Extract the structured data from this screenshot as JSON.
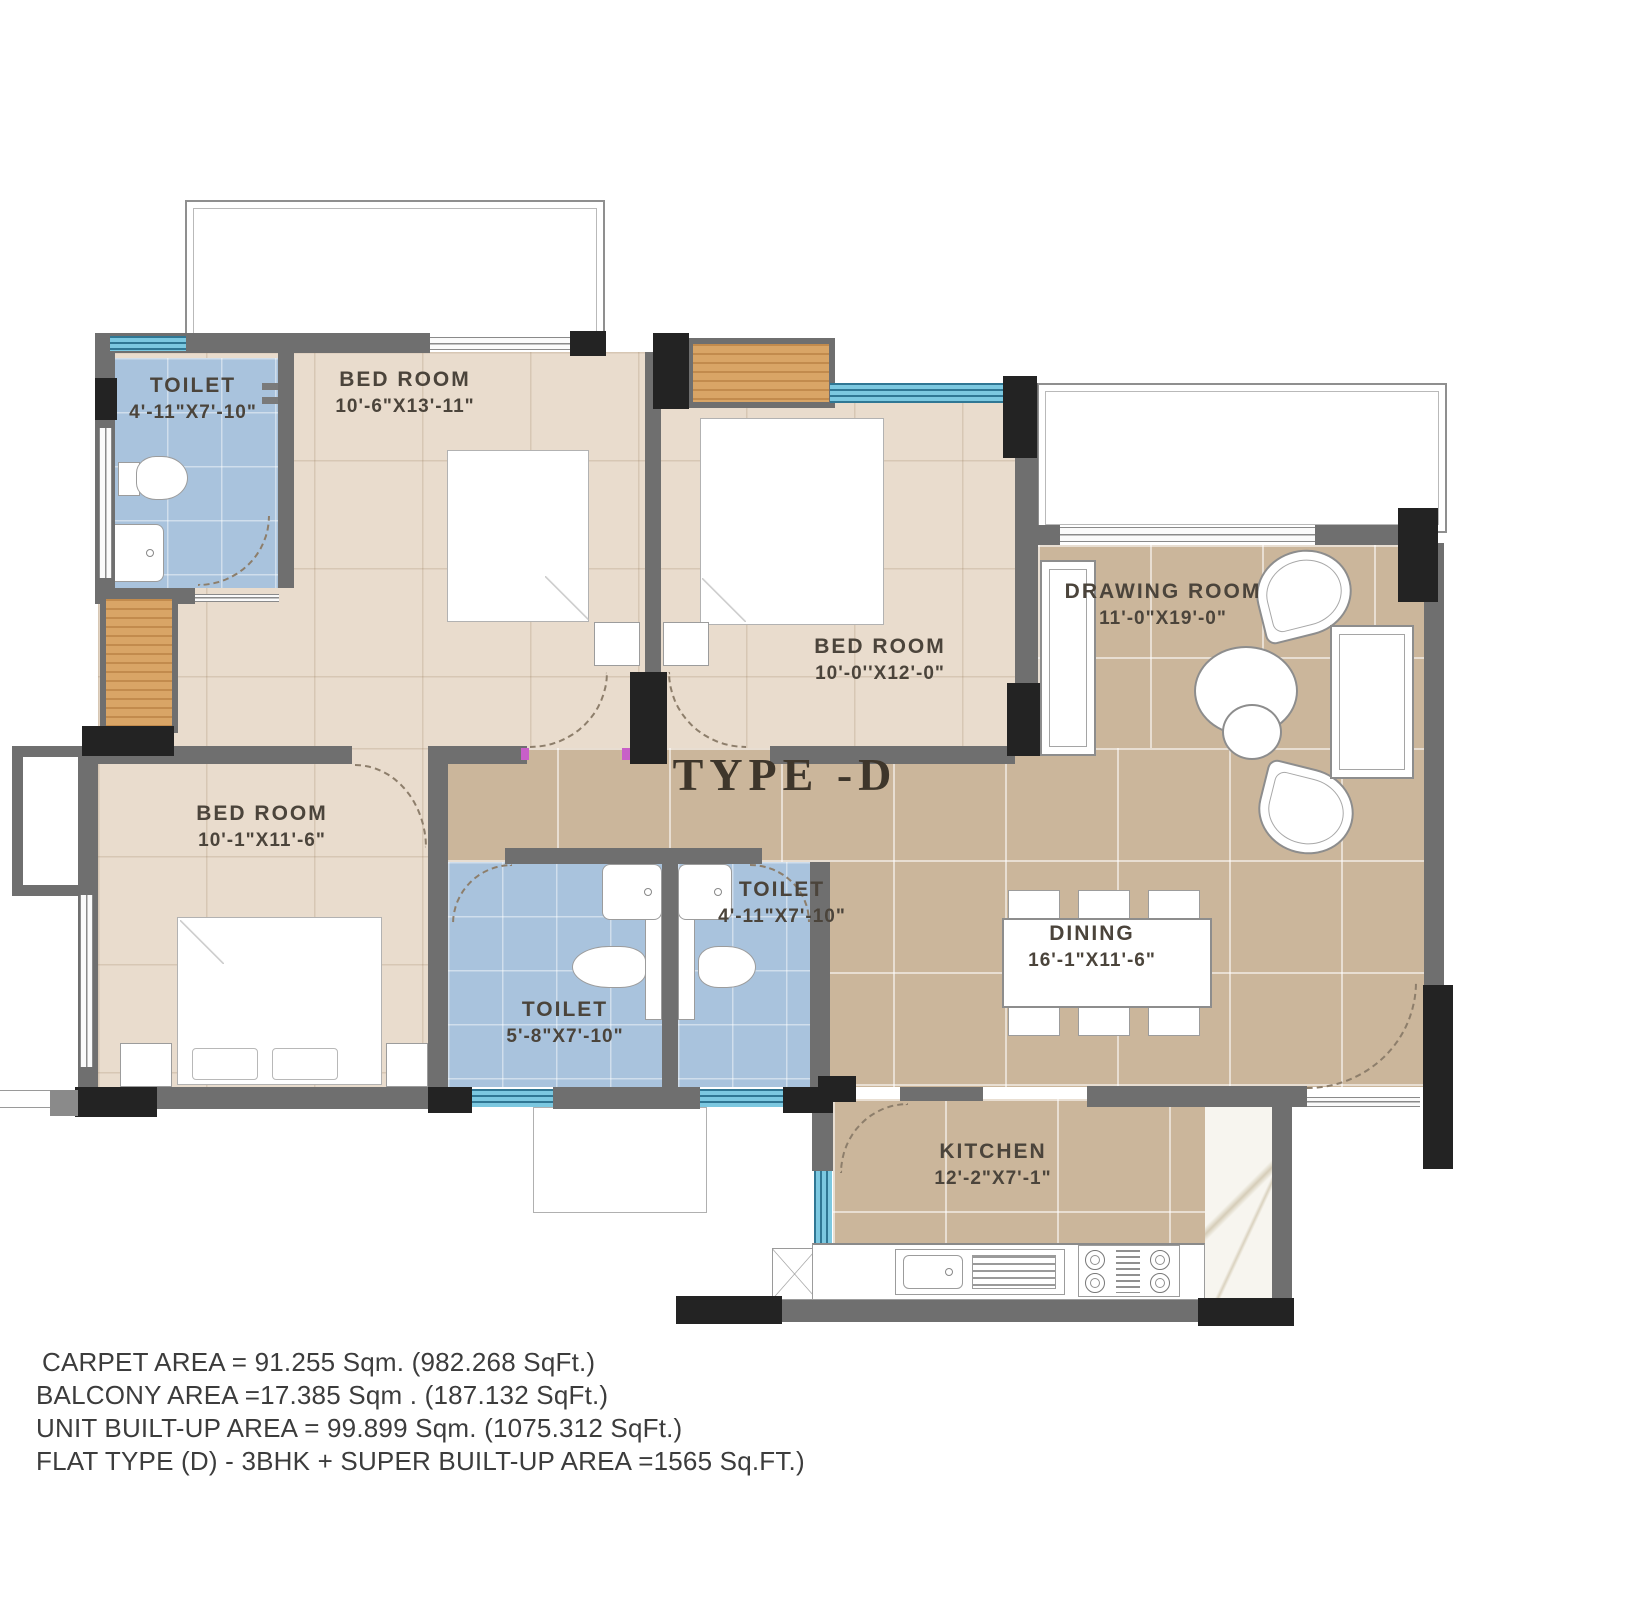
{
  "title": "TYPE -D",
  "rooms": {
    "toilet_top": {
      "name": "TOILET",
      "dims": "4'-11\"X7'-10\""
    },
    "bedroom_top": {
      "name": "BED ROOM",
      "dims": "10'-6\"X13'-11\""
    },
    "bedroom_mid": {
      "name": "BED ROOM",
      "dims": "10'-0''X12'-0\""
    },
    "drawing": {
      "name": "DRAWING ROOM",
      "dims": "11'-0\"X19'-0\""
    },
    "bedroom_left": {
      "name": "BED ROOM",
      "dims": "10'-1\"X11'-6\""
    },
    "toilet_mid_left": {
      "name": "TOILET",
      "dims": "5'-8\"X7'-10\""
    },
    "toilet_mid_right": {
      "name": "TOILET",
      "dims": "4'-11\"X7'-10\""
    },
    "dining": {
      "name": "DINING",
      "dims": "16'-1\"X11'-6\""
    },
    "kitchen": {
      "name": "KITCHEN",
      "dims": "12'-2\"X7'-1\""
    }
  },
  "footer": {
    "lines": [
      "CARPET AREA = 91.255 Sqm. (982.268 SqFt.)",
      "BALCONY AREA =17.385 Sqm . (187.132 SqFt.)",
      "UNIT BUILT-UP AREA = 99.899 Sqm. (1075.312 SqFt.)",
      "FLAT TYPE (D) - 3BHK + SUPER BUILT-UP AREA =1565 Sq.FT.)"
    ]
  },
  "colors": {
    "wall": "#6f6f6f",
    "column": "#232323",
    "floor_bedroom": "#e9dccd",
    "floor_living": "#cbb69b",
    "floor_toilet": "#a9c3dd",
    "window_glass": "#7cc8e0",
    "wood": "#d9a566",
    "label_text": "#4b443b",
    "door_hinge": "#c85fc8"
  }
}
